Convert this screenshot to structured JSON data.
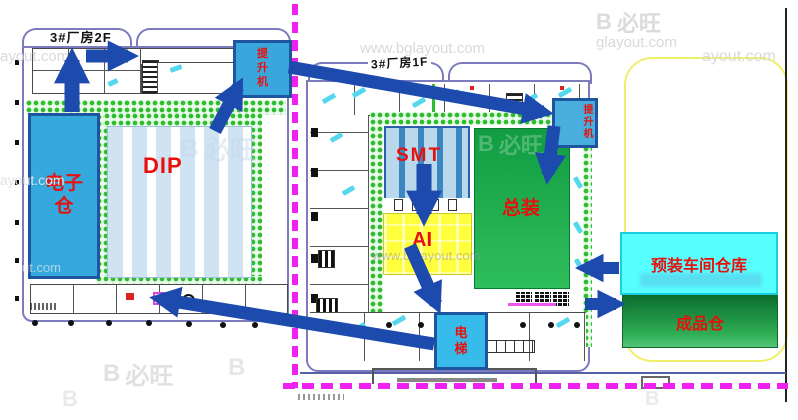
{
  "buildings": {
    "left": {
      "title": "3#厂房2F",
      "electronics_warehouse": "电子仓",
      "dip": "DIP",
      "hoist": "提升机"
    },
    "right": {
      "title": "3#厂房1F",
      "smt": "SMT",
      "ai": "AI",
      "final_assembly": "总装",
      "hoist": "提升机",
      "elevator": "电梯"
    }
  },
  "external": {
    "preassembly_warehouse": "预装车间仓库",
    "finished_goods_warehouse": "成品仓"
  },
  "watermark": {
    "logo_b": "B",
    "logo_text": "必旺",
    "url": "www.bglayout.com",
    "url_short": "ayout.com",
    "url_mid": "glayout.com",
    "url_tail": "ut.com"
  },
  "colors": {
    "arrow": "#1d4aad",
    "label_red": "#e8100c",
    "boundary_magenta": "#f020f0",
    "boundary_yellow": "#efef6a",
    "warehouse_blue": "#35a9de",
    "smt_blue": "#4fa6d9",
    "ai_yellow": "#ffff3d",
    "assembly_green_top": "#119c42",
    "assembly_green_bottom": "#2fbe5c",
    "preassembly_cyan": "#58ffff",
    "finished_green": "#0b6e2e",
    "corridor_green": "#2ebd2e",
    "building_outline": "#7b7bbd"
  }
}
